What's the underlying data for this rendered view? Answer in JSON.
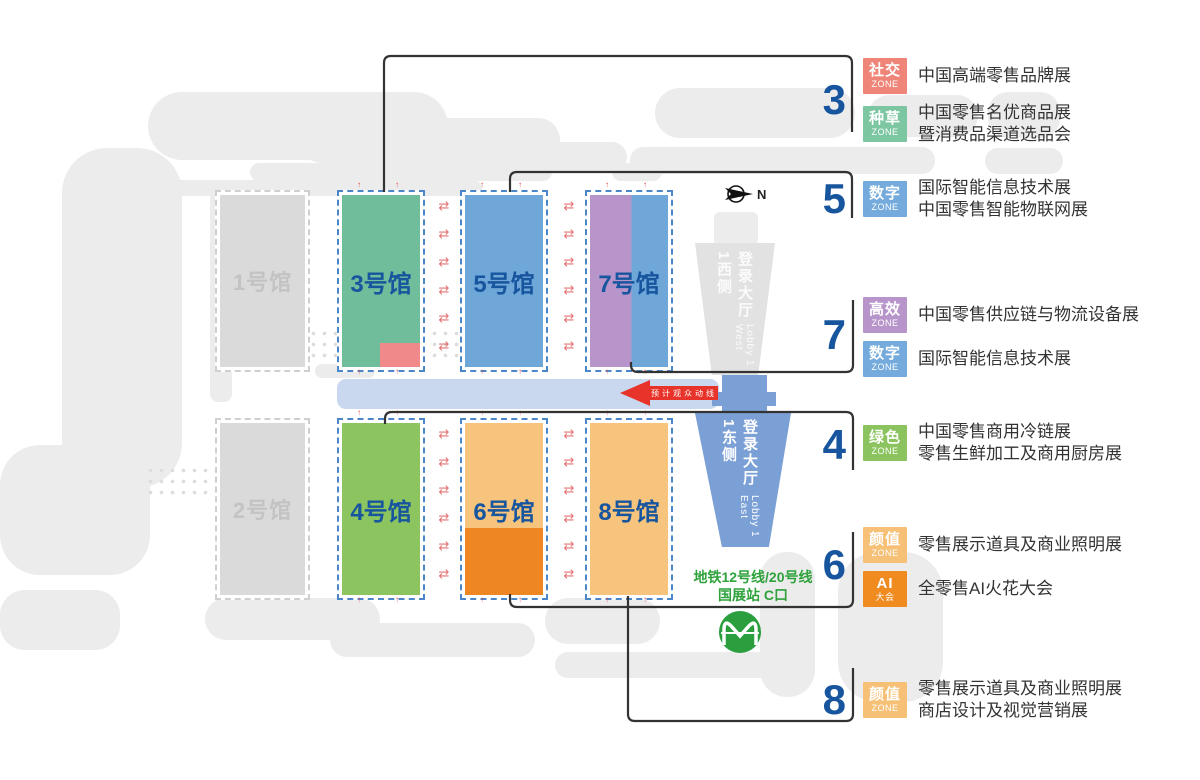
{
  "map": {
    "compass_n": "N",
    "flow_label": "预计观众动线",
    "gray_halls": [
      {
        "label": "1号馆"
      },
      {
        "label": "2号馆"
      }
    ],
    "halls": [
      {
        "label": "3号馆",
        "fill": "#6fbd9a",
        "chip": "#f08a8a"
      },
      {
        "label": "5号馆",
        "fill": "#6fa7d9"
      },
      {
        "label": "7号馆",
        "fill": "#b795cb",
        "fill2": "#6fa7d9",
        "split": "h"
      },
      {
        "label": "4号馆",
        "fill": "#8cc560"
      },
      {
        "label": "6号馆",
        "fill": "#f7c47d",
        "fill2": "#ee8722",
        "split": "v"
      },
      {
        "label": "8号馆",
        "fill": "#f7c47d"
      }
    ],
    "lobby_west": {
      "cn": "登录大厅1西侧",
      "en": "Lobby 1 West"
    },
    "lobby_east": {
      "cn": "登录大厅1东侧",
      "en": "Lobby 1 East"
    },
    "metro": {
      "line1": "地铁12号线/20号线",
      "line2": "国展站 C口"
    }
  },
  "legend": [
    {
      "number": "3",
      "zones": [
        {
          "badge": [
            "社交",
            "ZONE"
          ],
          "color": "#ef8578",
          "lines": [
            "中国高端零售品牌展"
          ]
        },
        {
          "badge": [
            "种草",
            "ZONE"
          ],
          "color": "#7cc6a1",
          "lines": [
            "中国零售名优商品展",
            "暨消费品渠道选品会"
          ]
        }
      ]
    },
    {
      "number": "5",
      "zones": [
        {
          "badge": [
            "数字",
            "ZONE"
          ],
          "color": "#74abdc",
          "lines": [
            "国际智能信息技术展",
            "中国零售智能物联网展"
          ]
        }
      ]
    },
    {
      "number": "7",
      "zones": [
        {
          "badge": [
            "高效",
            "ZONE"
          ],
          "color": "#b795cb",
          "lines": [
            "中国零售供应链与物流设备展"
          ]
        },
        {
          "badge": [
            "数字",
            "ZONE"
          ],
          "color": "#74abdc",
          "lines": [
            "国际智能信息技术展"
          ]
        }
      ]
    },
    {
      "number": "4",
      "zones": [
        {
          "badge": [
            "绿色",
            "ZONE"
          ],
          "color": "#8bc45f",
          "lines": [
            "中国零售商用冷链展",
            "零售生鲜加工及商用厨房展"
          ]
        }
      ]
    },
    {
      "number": "6",
      "zones": [
        {
          "badge": [
            "颜值",
            "ZONE"
          ],
          "color": "#f6c077",
          "lines": [
            "零售展示道具及商业照明展"
          ]
        },
        {
          "badge": [
            "AI",
            "大会"
          ],
          "color": "#ef8b1f",
          "lines": [
            "全零售AI火花大会"
          ]
        }
      ]
    },
    {
      "number": "8",
      "zones": [
        {
          "badge": [
            "颜值",
            "ZONE"
          ],
          "color": "#f6c077",
          "lines": [
            "零售展示道具及商业照明展",
            "商店设计及视觉营销展"
          ]
        }
      ]
    }
  ]
}
